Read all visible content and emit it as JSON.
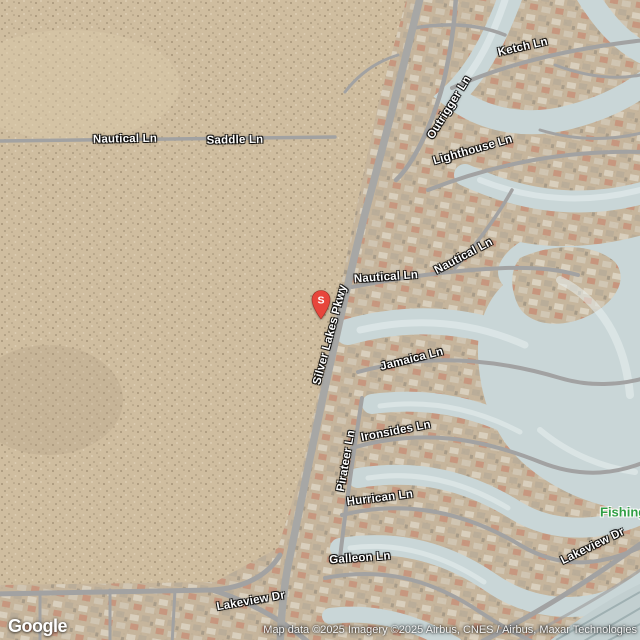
{
  "map": {
    "logo": "Google",
    "attribution": "Map data ©2025 Imagery ©2025 Airbus, CNES / Airbus, Maxar Technologies",
    "marker": {
      "label": "S",
      "color": "#e7463c"
    },
    "road_labels": [
      {
        "id": "nautical-ln-west",
        "text": "Nautical Ln"
      },
      {
        "id": "saddle-ln",
        "text": "Saddle Ln"
      },
      {
        "id": "ketch-ln",
        "text": "Ketch Ln"
      },
      {
        "id": "outrigger-ln",
        "text": "Outrigger Ln"
      },
      {
        "id": "lighthouse-ln",
        "text": "Lighthouse Ln"
      },
      {
        "id": "nautical-ln-mid",
        "text": "Nautical Ln"
      },
      {
        "id": "nautical-ln-east",
        "text": "Nautical Ln"
      },
      {
        "id": "silver-lakes-pkwy",
        "text": "Silver Lakes Pkwy"
      },
      {
        "id": "jamaica-ln",
        "text": "Jamaica Ln"
      },
      {
        "id": "ironsides-ln",
        "text": "Ironsides Ln"
      },
      {
        "id": "pirateer-ln",
        "text": "Pirateer Ln"
      },
      {
        "id": "hurrican-ln",
        "text": "Hurrican Ln"
      },
      {
        "id": "galleon-ln",
        "text": "Galleon Ln"
      },
      {
        "id": "lakeview-dr-west",
        "text": "Lakeview Dr"
      },
      {
        "id": "lakeview-dr-east",
        "text": "Lakeview Dr"
      }
    ],
    "poi_labels": [
      {
        "id": "fishing",
        "text": "Fishing",
        "color": "#2f9e44"
      }
    ],
    "colors": {
      "desert": "#cfbd9f",
      "residential_ground": "#c4b49b",
      "water": "#c9d6d7",
      "road": "#a2a2a2",
      "marker_red": "#e7463c",
      "poi_green": "#2f9e44"
    }
  }
}
